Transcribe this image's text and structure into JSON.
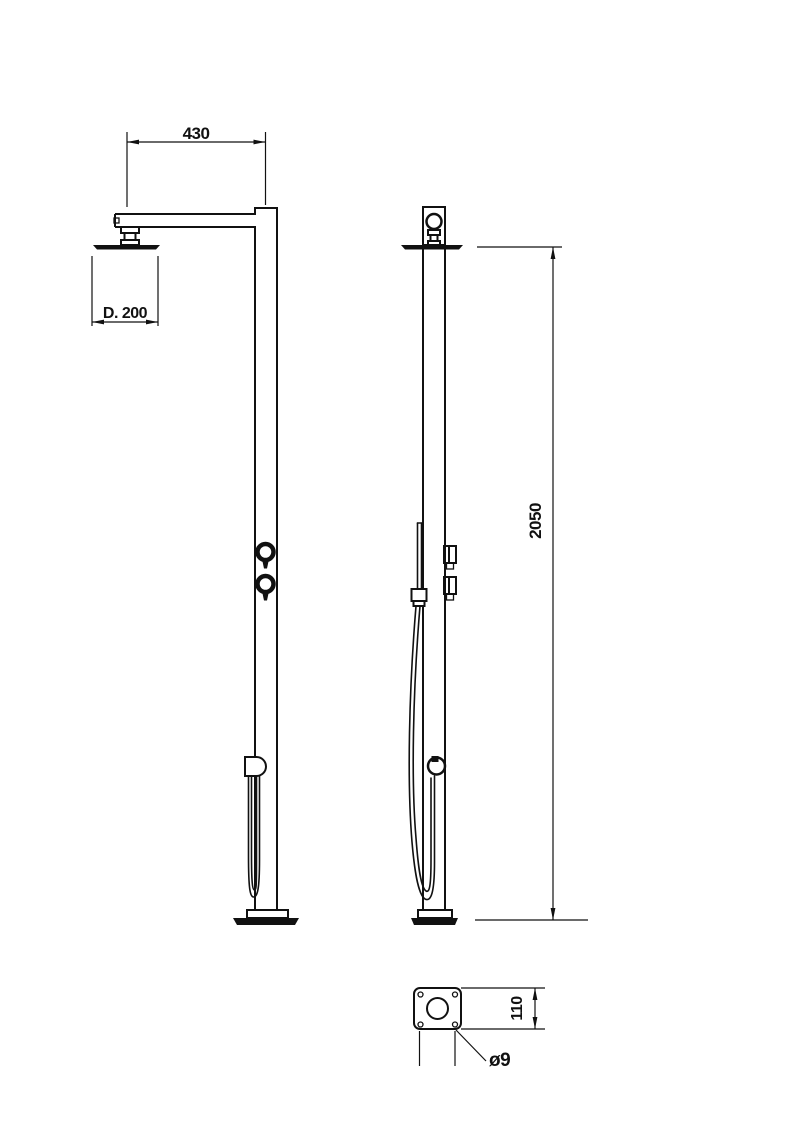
{
  "drawing": {
    "subject": "freestanding-shower-column-technical-drawing",
    "background_color": "#ffffff",
    "line_color": "#111111",
    "dimensions": {
      "arm_reach": "430",
      "head_diameter": "D. 200",
      "column_height": "2050",
      "base_plate_size": "110",
      "anchor_hole_diameter": "ø9"
    }
  }
}
